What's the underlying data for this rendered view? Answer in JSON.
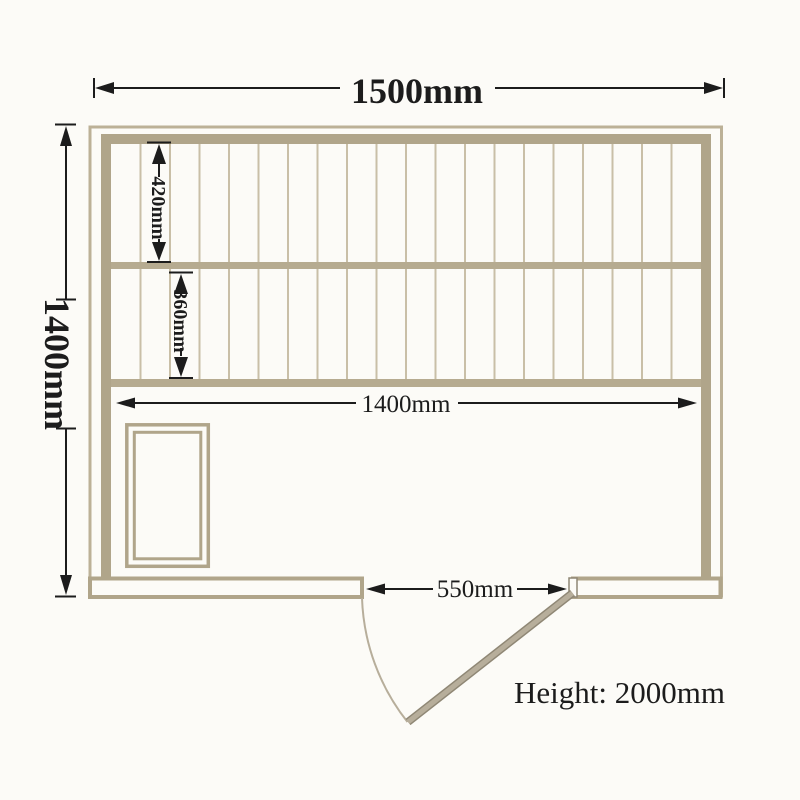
{
  "labels": {
    "width_total": "1500mm",
    "depth_total": "1400mm",
    "bench_upper_depth": "420mm",
    "bench_lower_depth": "360mm",
    "inner_width": "1400mm",
    "door_width": "550mm",
    "height_note": "Height: 2000mm"
  },
  "colors": {
    "background": "#fcfbf7",
    "line": "#1c1c1c",
    "wall": "#b0a58a",
    "wall_light": "#bcb197",
    "rail": "#b6ab90",
    "slat": "#c9bfa7",
    "door_leaf": "#b7ae9b",
    "door_edge": "#8f8775"
  },
  "slat_count": 20
}
